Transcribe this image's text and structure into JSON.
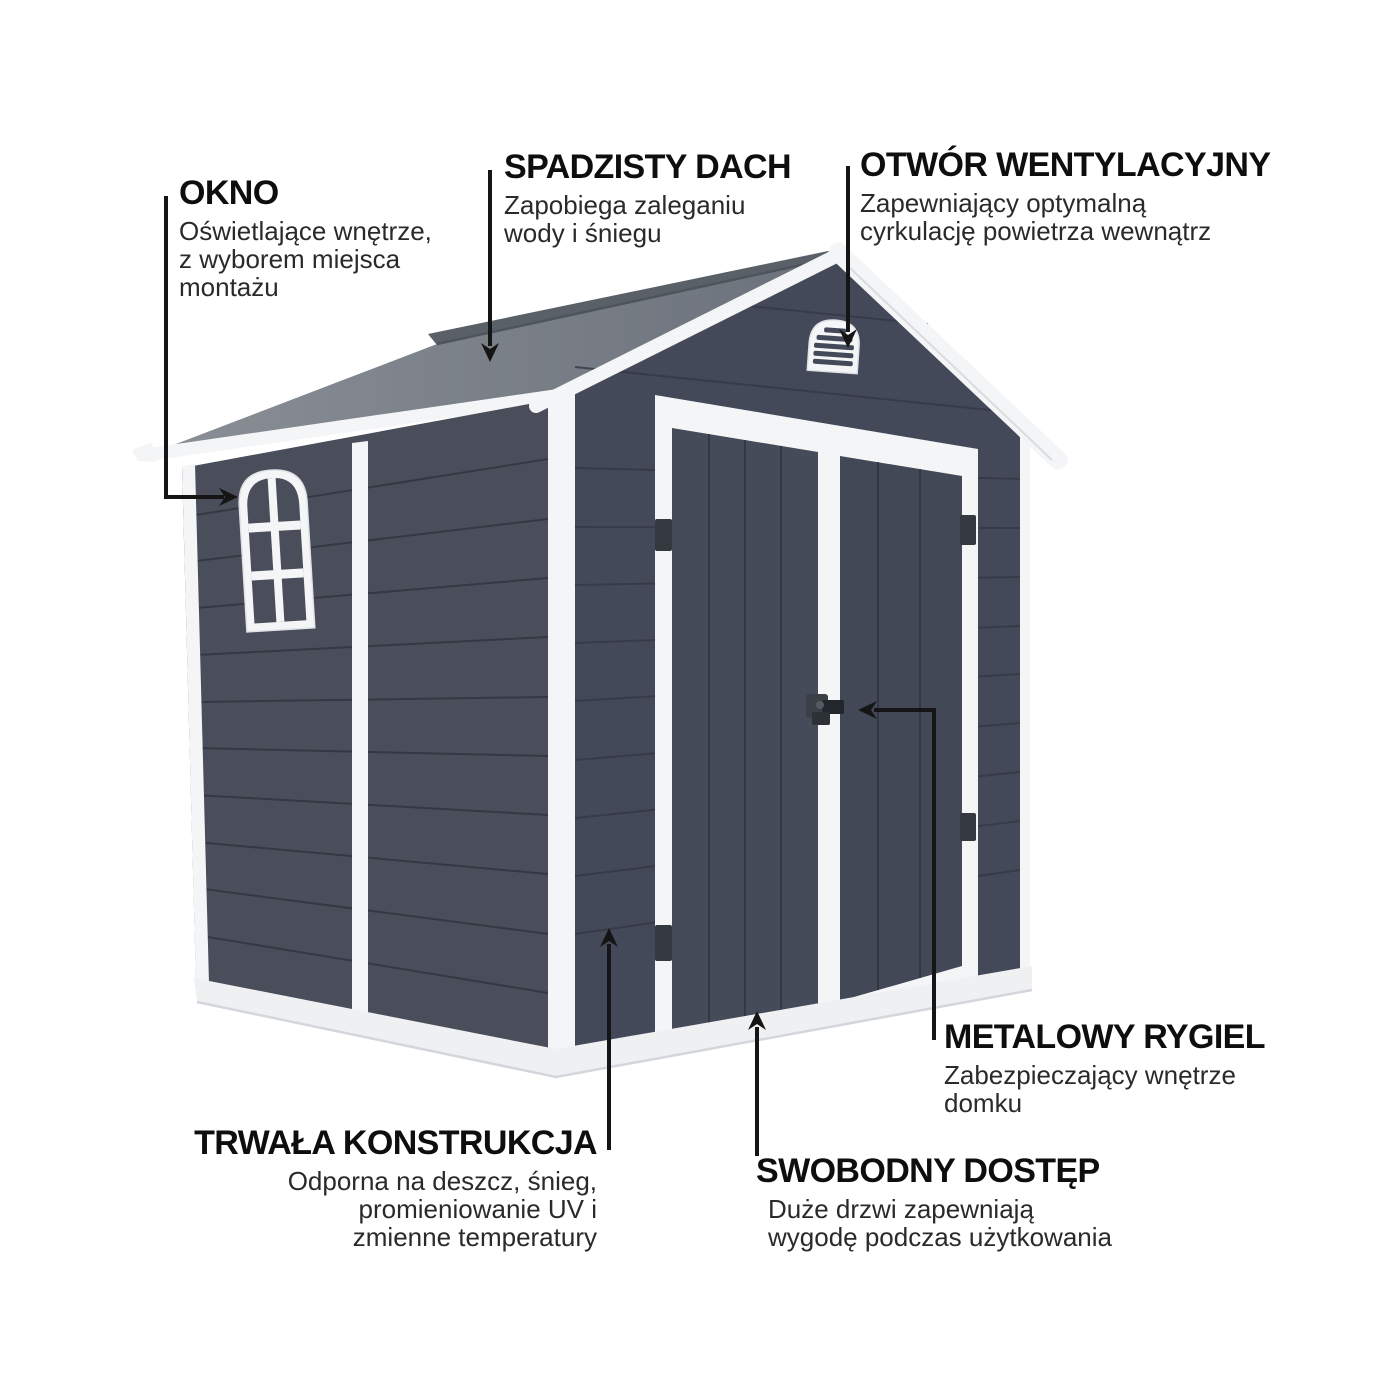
{
  "diagram": {
    "subject": "garden-shed-feature-infographic",
    "language": "pl",
    "annotations": [
      {
        "id": "okno",
        "title": "OKNO",
        "description": "Oświetlające wnętrze,\nz wyborem miejsca\nmontażu"
      },
      {
        "id": "spadzisty-dach",
        "title": "SPADZISTY DACH",
        "description": "Zapobiega zaleganiu\nwody i śniegu"
      },
      {
        "id": "otwor-wentylacyjny",
        "title": "OTWÓR WENTYLACYJNY",
        "description": "Zapewniający optymalną\ncyrkulację powietrza wewnątrz"
      },
      {
        "id": "metalowy-rygiel",
        "title": "METALOWY RYGIEL",
        "description": "Zabezpieczający wnętrze\ndomku"
      },
      {
        "id": "trwala-konstrukcja",
        "title": "TRWAŁA KONSTRUKCJA",
        "description": "Odporna na deszcz, śnieg,\npromieniowanie UV i\nzmienne temperatury"
      },
      {
        "id": "swobodny-dostep",
        "title": "SWOBODNY DOSTĘP",
        "description": "Duże drzwi zapewniają\nwygodę podczas użytkowania"
      }
    ],
    "palette": {
      "background": "#ffffff",
      "heading": "#0e0e0e",
      "body": "#2a2a2a",
      "arrow": "#151515",
      "wall_side": "#4a4e5b",
      "wall_front": "#444959",
      "door": "#464b59",
      "door_right": "#434856",
      "seam": "#30343e",
      "trim": "#f4f5f7",
      "trim_shadow": "#dde0e4",
      "roof_light": "#8a8f96",
      "roof_dark": "#6b717a",
      "roof_far": "#5a6068",
      "hardware": "#34383f",
      "base": "#eff0f2"
    }
  }
}
